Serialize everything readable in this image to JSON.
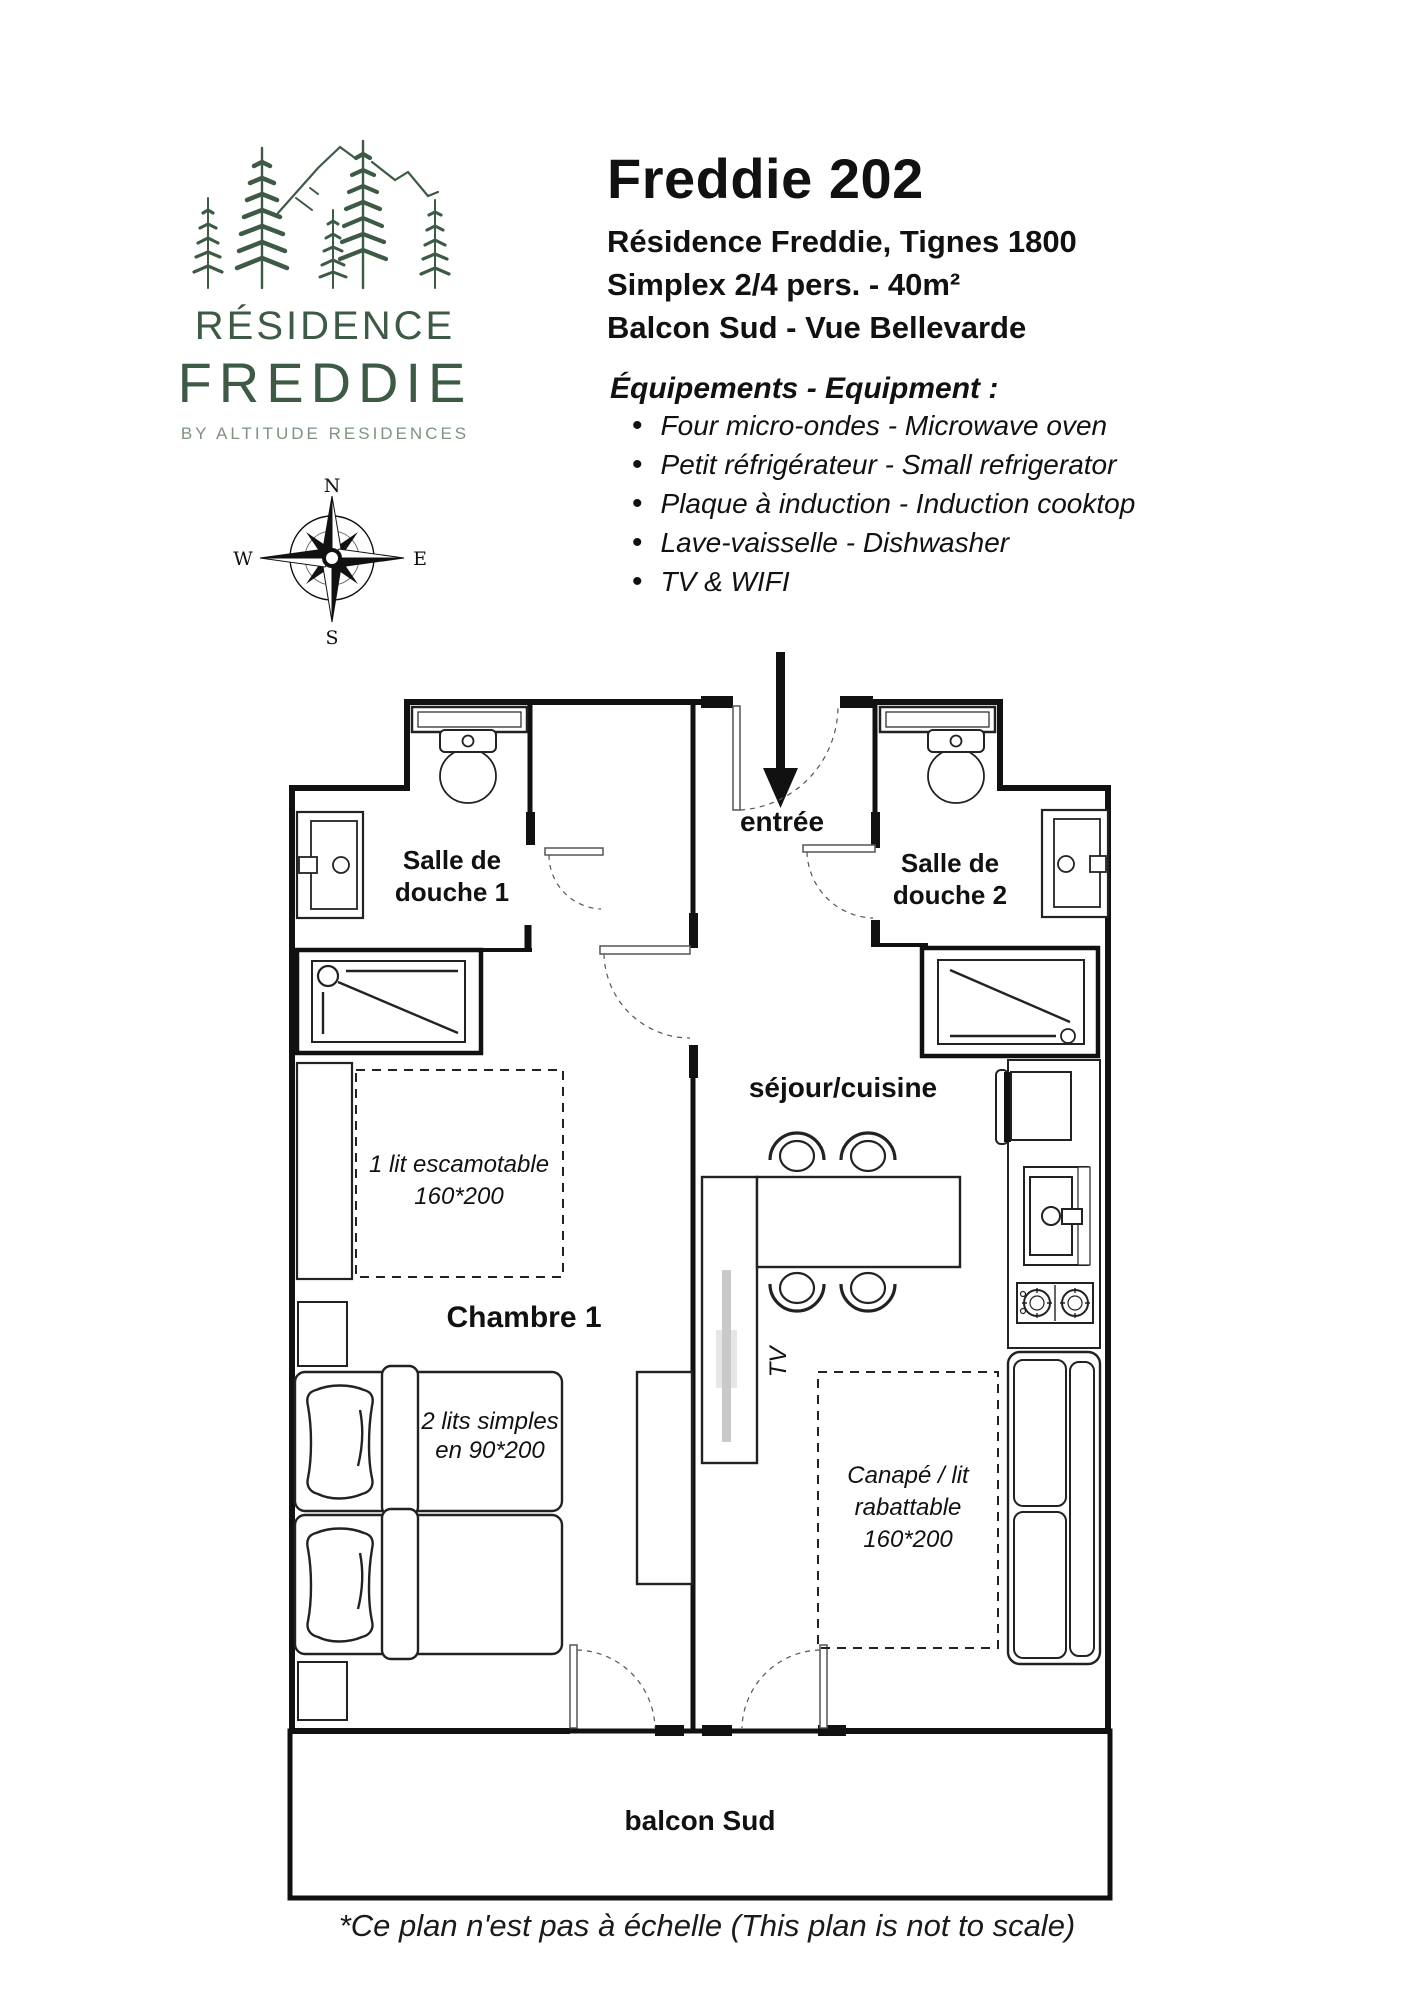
{
  "colors": {
    "brand_green": "#3d5a44",
    "brand_green_light": "#7e937f",
    "ink": "#111111",
    "tv_gray": "#c9c9c9"
  },
  "logo": {
    "line1": "RÉSIDENCE",
    "line2": "FREDDIE",
    "line3": "BY ALTITUDE RESIDENCES"
  },
  "compass": {
    "north": "N",
    "east": "E",
    "south": "S",
    "west": "W"
  },
  "header": {
    "title": "Freddie 202",
    "subtitles": [
      "Résidence Freddie, Tignes 1800",
      "Simplex 2/4 pers. - 40m²",
      "Balcon Sud - Vue Bellevarde"
    ]
  },
  "equipment": {
    "heading": "Équipements - Equipment :",
    "items": [
      "Four micro-ondes - Microwave oven",
      "Petit réfrigérateur - Small refrigerator",
      "Plaque à induction - Induction cooktop",
      "Lave-vaisselle - Dishwasher",
      "TV & WIFI"
    ]
  },
  "plan": {
    "entree": "entrée",
    "douche1": [
      "Salle de",
      "douche 1"
    ],
    "douche2": [
      "Salle de",
      "douche 2"
    ],
    "sejour": "séjour/cuisine",
    "chambre": "Chambre 1",
    "tv": "TV",
    "balcon": "balcon Sud",
    "lit_escamotable": [
      "1 lit escamotable",
      "160*200"
    ],
    "lits_simples": [
      "2 lits simples",
      "en 90*200"
    ],
    "canape": [
      "Canapé / lit",
      "rabattable",
      "160*200"
    ]
  },
  "footer": {
    "note": "*Ce plan n'est pas à échelle (This plan is not to scale)"
  }
}
